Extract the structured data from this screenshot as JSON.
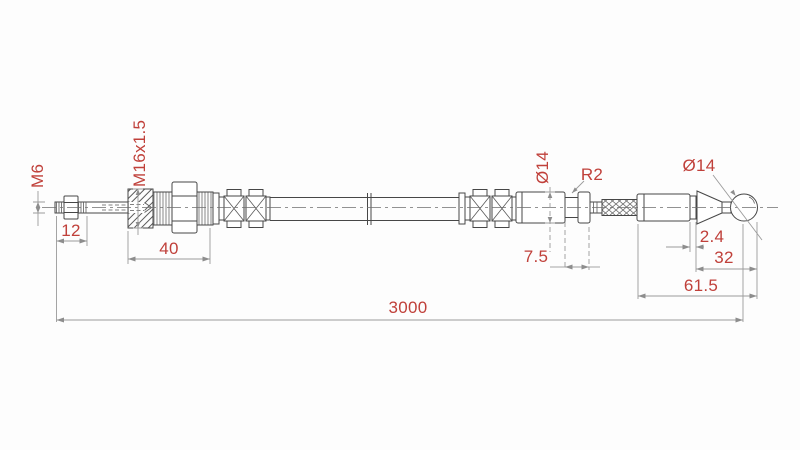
{
  "drawing": {
    "labels": {
      "m6": "M6",
      "dim12": "12",
      "m16": "M16x1.5",
      "dim40": "40",
      "dia14_left": "Ø14",
      "r2": "R2",
      "dim7_5": "7.5",
      "dia14_right": "Ø14",
      "dim2_4": "2.4",
      "dim32": "32",
      "dim61_5": "61.5",
      "dim3000": "3000"
    },
    "colors": {
      "dimension_text": "#c0403a",
      "part_outline": "#474747",
      "dimension_line": "#9b9b9b",
      "background": "#ffffff"
    }
  }
}
